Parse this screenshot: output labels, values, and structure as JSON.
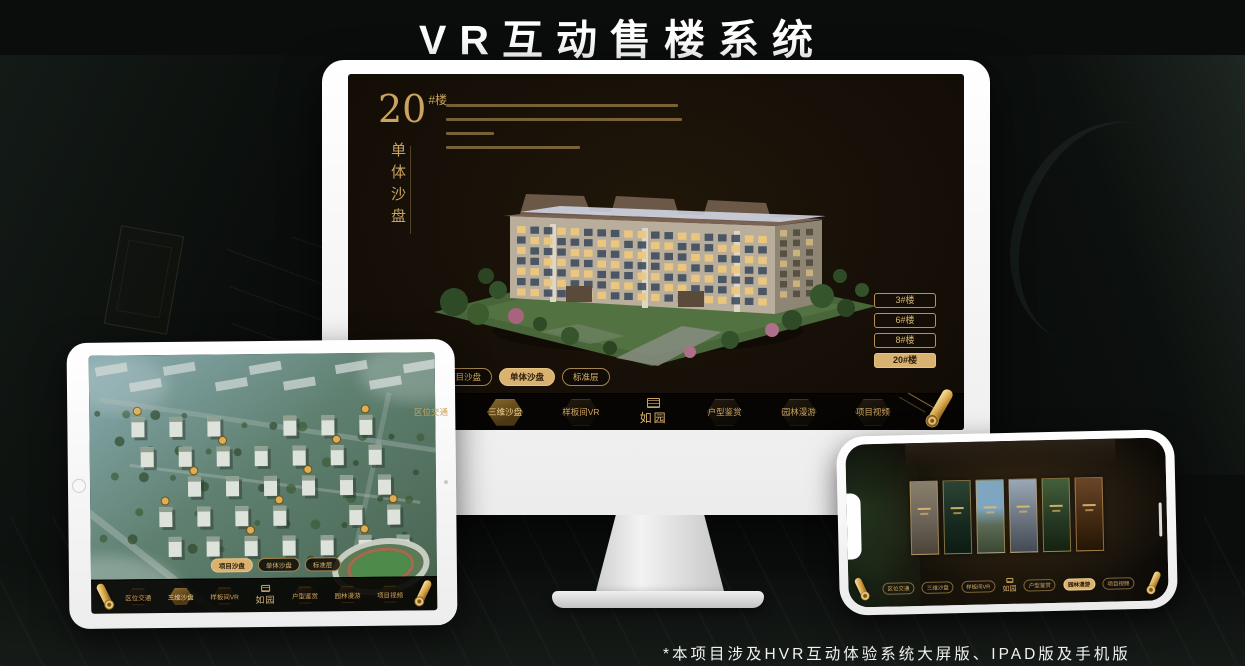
{
  "page": {
    "title": "VR互动售楼系统",
    "footnote": "*本项目涉及HVR互动体验系统大屏版、IPAD版及手机版"
  },
  "brand": {
    "logo": "如园"
  },
  "colors": {
    "gold": "#c9a35f",
    "gold_bright": "#ddb273",
    "screen_bg": "#171008",
    "menu_bg": "#070503",
    "frame_white": "#f4f4f4"
  },
  "monitor": {
    "headline": {
      "number": "20",
      "unit": "#楼",
      "subtitle": "单体沙盘"
    },
    "floor_buttons": [
      {
        "label": "3#楼",
        "active": false
      },
      {
        "label": "6#楼",
        "active": false
      },
      {
        "label": "8#楼",
        "active": false
      },
      {
        "label": "20#楼",
        "active": true
      }
    ],
    "sub_tabs": [
      {
        "label": "项目沙盘",
        "active": false
      },
      {
        "label": "单体沙盘",
        "active": true
      },
      {
        "label": "标准层",
        "active": false
      }
    ],
    "menu_items": [
      {
        "label": "区位交通",
        "active": false
      },
      {
        "label": "三维沙盘",
        "active": true
      },
      {
        "label": "样板间VR",
        "active": false
      },
      {
        "label": "户型鉴赏",
        "active": false
      },
      {
        "label": "园林漫游",
        "active": false
      },
      {
        "label": "项目视频",
        "active": false
      }
    ]
  },
  "tablet": {
    "sub_tabs": [
      {
        "label": "项目沙盘",
        "active": true
      },
      {
        "label": "单体沙盘",
        "active": false
      },
      {
        "label": "标准层",
        "active": false
      }
    ],
    "menu_items": [
      {
        "label": "区位交通",
        "active": false
      },
      {
        "label": "三维沙盘",
        "active": true
      },
      {
        "label": "样板间VR",
        "active": false
      },
      {
        "label": "户型鉴赏",
        "active": false
      },
      {
        "label": "园林漫游",
        "active": false
      },
      {
        "label": "项目视频",
        "active": false
      }
    ]
  },
  "phone": {
    "gallery_panel_count": 6,
    "menu_items": [
      {
        "label": "区位交通",
        "active": false
      },
      {
        "label": "三维沙盘",
        "active": false
      },
      {
        "label": "样板间VR",
        "active": false
      },
      {
        "label": "户型鉴赏",
        "active": false
      },
      {
        "label": "园林漫游",
        "active": true
      },
      {
        "label": "项目视频",
        "active": false
      }
    ]
  }
}
